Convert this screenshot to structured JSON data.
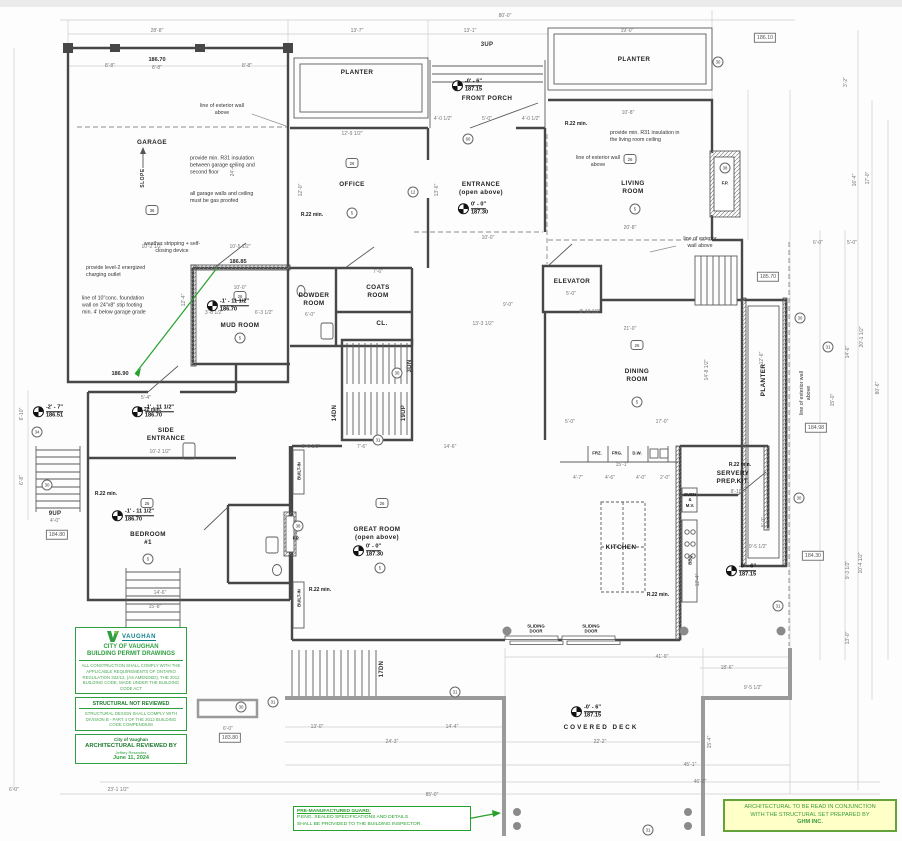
{
  "colors": {
    "wall": "#474747",
    "green": "#27a02c",
    "stamp_green": "#2f9e3f",
    "note_bg": "#ffffc8",
    "deck": "#9a9a9a"
  },
  "rooms": [
    {
      "name": "GARAGE",
      "x": 152,
      "y": 143
    },
    {
      "name": "PLANTER",
      "x": 357,
      "y": 73
    },
    {
      "name": "FRONT PORCH",
      "x": 487,
      "y": 99
    },
    {
      "name": "PLANTER",
      "x": 634,
      "y": 60
    },
    {
      "name": "OFFICE",
      "x": 352,
      "y": 185
    },
    {
      "name": "ENTRANCE\n(open above)",
      "x": 481,
      "y": 189
    },
    {
      "name": "LIVING\nROOM",
      "x": 633,
      "y": 188
    },
    {
      "name": "ELEVATOR",
      "x": 572,
      "y": 282
    },
    {
      "name": "POWDER\nROOM",
      "x": 314,
      "y": 300
    },
    {
      "name": "COATS\nROOM",
      "x": 378,
      "y": 292
    },
    {
      "name": "CL.",
      "x": 382,
      "y": 324
    },
    {
      "name": "MUD ROOM",
      "x": 240,
      "y": 326
    },
    {
      "name": "SIDE\nENTRANCE",
      "x": 166,
      "y": 435
    },
    {
      "name": "DINING\nROOM",
      "x": 637,
      "y": 376
    },
    {
      "name": "PLANTER",
      "x": 764,
      "y": 380,
      "r": -90
    },
    {
      "name": "BEDROOM\n#1",
      "x": 148,
      "y": 539
    },
    {
      "name": "GREAT ROOM\n(open above)",
      "x": 377,
      "y": 534
    },
    {
      "name": "KITCHEN",
      "x": 621,
      "y": 548
    },
    {
      "name": "SERVERY\nPREP.KIT.",
      "x": 733,
      "y": 478
    },
    {
      "name": "COVERED  DECK",
      "x": 601,
      "y": 728,
      "cls": "wide"
    }
  ],
  "elev_markers": [
    {
      "level": "-0' - 6\"",
      "elev": "187.15",
      "x": 467,
      "y": 86
    },
    {
      "level": "0' - 0\"",
      "elev": "187.30",
      "x": 473,
      "y": 209
    },
    {
      "level": "-1' - 11 1/2\"",
      "elev": "186.70",
      "x": 228,
      "y": 306
    },
    {
      "level": "-1' - 11 1/2\"",
      "elev": "186.70",
      "x": 153,
      "y": 412
    },
    {
      "level": "-2' - 7\"",
      "elev": "186.51",
      "x": 48,
      "y": 412
    },
    {
      "level": "-1' - 11 1/2\"",
      "elev": "186.70",
      "x": 133,
      "y": 516
    },
    {
      "level": "0' - 0\"",
      "elev": "187.30",
      "x": 368,
      "y": 551
    },
    {
      "level": "-0' - 6\"",
      "elev": "187.15",
      "x": 741,
      "y": 571
    },
    {
      "level": "-0' - 6\"",
      "elev": "187.15",
      "x": 586,
      "y": 712
    }
  ],
  "plain_elevs": [
    {
      "t": "186.70",
      "x": 157,
      "y": 60
    },
    {
      "t": "186.85",
      "x": 238,
      "y": 262
    },
    {
      "t": "186.90",
      "x": 120,
      "y": 374
    }
  ],
  "boxed_elevs": [
    {
      "t": "186.10",
      "x": 765,
      "y": 38
    },
    {
      "t": "185.70",
      "x": 768,
      "y": 277
    },
    {
      "t": "184.98",
      "x": 816,
      "y": 428
    },
    {
      "t": "184.30",
      "x": 813,
      "y": 556
    },
    {
      "t": "184.80",
      "x": 57,
      "y": 535
    },
    {
      "t": "183.80",
      "x": 230,
      "y": 738
    }
  ],
  "stair_labels": [
    {
      "t": "3UP",
      "x": 487,
      "y": 45
    },
    {
      "t": "9UP",
      "x": 55,
      "y": 514
    },
    {
      "t": "14DN",
      "x": 335,
      "y": 413,
      "r": -90
    },
    {
      "t": "19UP",
      "x": 404,
      "y": 413,
      "r": -90
    },
    {
      "t": "3DN",
      "x": 410,
      "y": 366,
      "r": -90
    },
    {
      "t": "17DN",
      "x": 382,
      "y": 669,
      "r": -90
    }
  ],
  "fixtures": [
    {
      "t": "F.P.",
      "x": 725,
      "y": 183
    },
    {
      "t": "F.P.",
      "x": 296,
      "y": 538
    },
    {
      "t": "BUILT-IN",
      "x": 299,
      "y": 471,
      "r": -90
    },
    {
      "t": "BUILT-IN",
      "x": 299,
      "y": 598,
      "r": -90
    },
    {
      "t": "FRZ.",
      "x": 597,
      "y": 453
    },
    {
      "t": "FRG.",
      "x": 617,
      "y": 453
    },
    {
      "t": "D.W.",
      "x": 637,
      "y": 453
    },
    {
      "t": "OVEN\n&\nM.V.",
      "x": 690,
      "y": 500
    },
    {
      "t": "BBQ",
      "x": 690,
      "y": 560,
      "r": -90
    },
    {
      "t": "SLIDING\nDOOR",
      "x": 536,
      "y": 629
    },
    {
      "t": "SLIDING\nDOOR",
      "x": 591,
      "y": 629
    }
  ],
  "r22_notes": [
    {
      "t": "R.22 min.",
      "x": 312,
      "y": 215
    },
    {
      "t": "R.22 min.",
      "x": 576,
      "y": 124
    },
    {
      "t": "R.22 min.",
      "x": 150,
      "y": 410
    },
    {
      "t": "R.22 min.",
      "x": 106,
      "y": 494
    },
    {
      "t": "R.22 min.",
      "x": 320,
      "y": 590
    },
    {
      "t": "R.22 min.",
      "x": 658,
      "y": 595
    },
    {
      "t": "R.22 min.",
      "x": 740,
      "y": 465
    }
  ],
  "notes": [
    {
      "t": "line of exterior wall\nabove",
      "x": 222,
      "y": 110,
      "cls": "c"
    },
    {
      "t": "provide min. R31 insulation\nbetween garage ceiling and\nsecond floor",
      "x": 190,
      "y": 166,
      "al": "l"
    },
    {
      "t": "all garage walls and ceiling\nmust be gas proofed",
      "x": 190,
      "y": 198,
      "al": "l"
    },
    {
      "t": "weather stripping + self-\nclosing device",
      "x": 172,
      "y": 248,
      "cls": "c"
    },
    {
      "t": "provide level-2 energized\ncharging outlet",
      "x": 86,
      "y": 272,
      "al": "l"
    },
    {
      "t": "line of 10\"conc. foundation\nwall on 24\"x8\" stip footing\nmin. 4' below garage grade",
      "x": 82,
      "y": 306,
      "al": "l"
    },
    {
      "t": "provide min. R31 insulation in\nthe living room ceiling",
      "x": 610,
      "y": 137,
      "al": "l"
    },
    {
      "t": "line of exterior wall\nabove",
      "x": 598,
      "y": 162,
      "cls": "c"
    },
    {
      "t": "line of exterior\nwall above",
      "x": 700,
      "y": 243,
      "cls": "c"
    },
    {
      "t": "line of exterior wall\nabove",
      "x": 806,
      "y": 393,
      "cls": "c",
      "r": -90
    },
    {
      "t": "SLOPE",
      "x": 143,
      "y": 178,
      "cls": "slope",
      "r": -90
    }
  ],
  "tags": [
    {
      "n": "36",
      "x": 152,
      "y": 210,
      "shape": "hex"
    },
    {
      "n": "26",
      "x": 352,
      "y": 163,
      "shape": "hex"
    },
    {
      "n": "26",
      "x": 630,
      "y": 159,
      "shape": "hex"
    },
    {
      "n": "26",
      "x": 240,
      "y": 296,
      "shape": "hex"
    },
    {
      "n": "26",
      "x": 637,
      "y": 345,
      "shape": "hex"
    },
    {
      "n": "26",
      "x": 382,
      "y": 503,
      "shape": "hex"
    },
    {
      "n": "26",
      "x": 147,
      "y": 503,
      "shape": "hex"
    },
    {
      "n": "5",
      "x": 352,
      "y": 213,
      "shape": "circ"
    },
    {
      "n": "5",
      "x": 635,
      "y": 209,
      "shape": "circ"
    },
    {
      "n": "5",
      "x": 240,
      "y": 338,
      "shape": "circ"
    },
    {
      "n": "5",
      "x": 637,
      "y": 402,
      "shape": "circ"
    },
    {
      "n": "5",
      "x": 380,
      "y": 568,
      "shape": "circ"
    },
    {
      "n": "5",
      "x": 148,
      "y": 559,
      "shape": "circ"
    },
    {
      "n": "12",
      "x": 413,
      "y": 192,
      "shape": "circ"
    },
    {
      "n": "60",
      "x": 468,
      "y": 139,
      "shape": "circ"
    },
    {
      "n": "30",
      "x": 718,
      "y": 62,
      "shape": "circ"
    },
    {
      "n": "30",
      "x": 397,
      "y": 373,
      "shape": "circ"
    },
    {
      "n": "31",
      "x": 378,
      "y": 440,
      "shape": "circ"
    },
    {
      "n": "34",
      "x": 37,
      "y": 432,
      "shape": "circ"
    },
    {
      "n": "30",
      "x": 47,
      "y": 485,
      "shape": "circ"
    },
    {
      "n": "30",
      "x": 241,
      "y": 707,
      "shape": "circ"
    },
    {
      "n": "31",
      "x": 273,
      "y": 702,
      "shape": "circ"
    },
    {
      "n": "31",
      "x": 455,
      "y": 692,
      "shape": "circ"
    },
    {
      "n": "30",
      "x": 800,
      "y": 318,
      "shape": "circ"
    },
    {
      "n": "31",
      "x": 828,
      "y": 347,
      "shape": "circ"
    },
    {
      "n": "30",
      "x": 799,
      "y": 498,
      "shape": "circ"
    },
    {
      "n": "31",
      "x": 778,
      "y": 606,
      "shape": "circ"
    },
    {
      "n": "38",
      "x": 725,
      "y": 168,
      "shape": "circ"
    },
    {
      "n": "38",
      "x": 298,
      "y": 526,
      "shape": "circ"
    },
    {
      "n": "31",
      "x": 648,
      "y": 830,
      "shape": "circ"
    }
  ],
  "dims": [
    {
      "t": "80'-0\"",
      "x": 505,
      "y": 16
    },
    {
      "t": "28'-8\"",
      "x": 157,
      "y": 31
    },
    {
      "t": "13'-7\"",
      "x": 357,
      "y": 31
    },
    {
      "t": "13'-1\"",
      "x": 470,
      "y": 31
    },
    {
      "t": "19'-0\"",
      "x": 627,
      "y": 31
    },
    {
      "t": "8'-8\"",
      "x": 110,
      "y": 66
    },
    {
      "t": "8'-8\"",
      "x": 157,
      "y": 68
    },
    {
      "t": "8'-8\"",
      "x": 247,
      "y": 66
    },
    {
      "t": "4'-0 1/2\"",
      "x": 443,
      "y": 119
    },
    {
      "t": "5'-0\"",
      "x": 487,
      "y": 119
    },
    {
      "t": "4'-0 1/2\"",
      "x": 531,
      "y": 119
    },
    {
      "t": "10'-8\"",
      "x": 628,
      "y": 113
    },
    {
      "t": "12'-9 1/2\"",
      "x": 352,
      "y": 134
    },
    {
      "t": "20'-8\"",
      "x": 630,
      "y": 228
    },
    {
      "t": "12'-0\"",
      "x": 301,
      "y": 190,
      "r": -90
    },
    {
      "t": "13'-6\"",
      "x": 437,
      "y": 190,
      "r": -90
    },
    {
      "t": "24'-4\"",
      "x": 233,
      "y": 170,
      "r": -90
    },
    {
      "t": "10'-2 1/2\"",
      "x": 152,
      "y": 247
    },
    {
      "t": "10'-5 1/2\"",
      "x": 240,
      "y": 247
    },
    {
      "t": "12'-4\"",
      "x": 184,
      "y": 300,
      "r": -90
    },
    {
      "t": "10'-0\"",
      "x": 240,
      "y": 288
    },
    {
      "t": "3'-8 1/2\"",
      "x": 214,
      "y": 313
    },
    {
      "t": "6'-3 1/2\"",
      "x": 264,
      "y": 313
    },
    {
      "t": "7'-6\"",
      "x": 378,
      "y": 272
    },
    {
      "t": "6'-0\"",
      "x": 310,
      "y": 315
    },
    {
      "t": "9'-0\"",
      "x": 508,
      "y": 305
    },
    {
      "t": "13'-3 1/2\"",
      "x": 483,
      "y": 324
    },
    {
      "t": "8'-10 1/2\"",
      "x": 590,
      "y": 312
    },
    {
      "t": "5'-0\"",
      "x": 571,
      "y": 294
    },
    {
      "t": "21'-0\"",
      "x": 630,
      "y": 329
    },
    {
      "t": "17'-0\"",
      "x": 662,
      "y": 422
    },
    {
      "t": "5'-0\"",
      "x": 570,
      "y": 422
    },
    {
      "t": "14'-8 1/2\"",
      "x": 707,
      "y": 370,
      "r": -90
    },
    {
      "t": "5'-4\"",
      "x": 146,
      "y": 398
    },
    {
      "t": "10'-2 1/2\"",
      "x": 160,
      "y": 452
    },
    {
      "t": "15'-8\"",
      "x": 155,
      "y": 607
    },
    {
      "t": "14'-6\"",
      "x": 160,
      "y": 593
    },
    {
      "t": "6'-10\"",
      "x": 22,
      "y": 414,
      "r": -90
    },
    {
      "t": "6'-8\"",
      "x": 22,
      "y": 480,
      "r": -90
    },
    {
      "t": "4'-0\"",
      "x": 55,
      "y": 521
    },
    {
      "t": "5'-6 1/2\"",
      "x": 311,
      "y": 447
    },
    {
      "t": "7'-6\"",
      "x": 362,
      "y": 447
    },
    {
      "t": "14'-6\"",
      "x": 450,
      "y": 447
    },
    {
      "t": "22'-3 1/2\"",
      "x": 297,
      "y": 530,
      "r": -90
    },
    {
      "t": "15'-1\"",
      "x": 622,
      "y": 465
    },
    {
      "t": "4'-7\"",
      "x": 578,
      "y": 478
    },
    {
      "t": "4'-6\"",
      "x": 610,
      "y": 478
    },
    {
      "t": "4'-0\"",
      "x": 641,
      "y": 478
    },
    {
      "t": "2'-0\"",
      "x": 665,
      "y": 478
    },
    {
      "t": "8'-10\"",
      "x": 737,
      "y": 492
    },
    {
      "t": "9'-5 1/2\"",
      "x": 758,
      "y": 547
    },
    {
      "t": "12'-4\"",
      "x": 698,
      "y": 580,
      "r": -90
    },
    {
      "t": "12'-6\"",
      "x": 762,
      "y": 358,
      "r": -90
    },
    {
      "t": "5'-0\"",
      "x": 764,
      "y": 522,
      "r": -90
    },
    {
      "t": "6'-0\"",
      "x": 818,
      "y": 243
    },
    {
      "t": "5'-0\"",
      "x": 852,
      "y": 243
    },
    {
      "t": "3'-2\"",
      "x": 846,
      "y": 82,
      "r": -90
    },
    {
      "t": "16'-4\"",
      "x": 855,
      "y": 180,
      "r": -90
    },
    {
      "t": "17'-0\"",
      "x": 868,
      "y": 178,
      "r": -90
    },
    {
      "t": "20'-1 1/2\"",
      "x": 862,
      "y": 337,
      "r": -90
    },
    {
      "t": "14'-6\"",
      "x": 848,
      "y": 352,
      "r": -90
    },
    {
      "t": "80'-6\"",
      "x": 878,
      "y": 388,
      "r": -90
    },
    {
      "t": "15'-0\"",
      "x": 833,
      "y": 400,
      "r": -90
    },
    {
      "t": "9'-3 1/2\"",
      "x": 848,
      "y": 570,
      "r": -90
    },
    {
      "t": "10'-4 1/2\"",
      "x": 861,
      "y": 563,
      "r": -90
    },
    {
      "t": "13'-0\"",
      "x": 848,
      "y": 638,
      "r": -90
    },
    {
      "t": "9'-5 1/2\"",
      "x": 753,
      "y": 688
    },
    {
      "t": "15'-4\"",
      "x": 710,
      "y": 742,
      "r": -90
    },
    {
      "t": "41'-9\"",
      "x": 662,
      "y": 657
    },
    {
      "t": "18'-6\"",
      "x": 727,
      "y": 668
    },
    {
      "t": "13'-0\"",
      "x": 317,
      "y": 727
    },
    {
      "t": "14'-4\"",
      "x": 452,
      "y": 727
    },
    {
      "t": "24'-3\"",
      "x": 392,
      "y": 742
    },
    {
      "t": "22'-2\"",
      "x": 600,
      "y": 742
    },
    {
      "t": "45'-1\"",
      "x": 690,
      "y": 765
    },
    {
      "t": "46'-5\"",
      "x": 700,
      "y": 782
    },
    {
      "t": "85'-0\"",
      "x": 432,
      "y": 795
    },
    {
      "t": "23'-1 1/2\"",
      "x": 118,
      "y": 790
    },
    {
      "t": "6'-0\"",
      "x": 228,
      "y": 729
    },
    {
      "t": "6'-0\"",
      "x": 14,
      "y": 790
    },
    {
      "t": "10'-0\"",
      "x": 488,
      "y": 238
    }
  ],
  "stamp": {
    "logo_text": "VAUGHAN",
    "title": "CITY OF VAUGHAN\nBUILDING PERMIT DRAWINGS",
    "body": "ALL CONSTRUCTION SHALL COMPLY WITH THE APPLICABLE REQUIREMENTS OF ONTARIO REGULATION 332/12, (AS AMENDED), THE 2012 BUILDING CODE, MADE UNDER THE BUILDING CODE ACT",
    "structural_title": "STRUCTURAL NOT REVIEWED",
    "structural_body": "STRUCTURAL DESIGN SHALL COMPLY WITH DIVISION B - PART 4 OF THE 2012 BUILDING CODE COMPENDIUM",
    "reviewed_org": "City of Vaughan",
    "reviewed_title": "ARCHITECTURAL REVIEWED BY",
    "reviewer": "Jeffrey Resendes",
    "date": "June 11, 2024"
  },
  "guard_note": {
    "title": "PRE-MANUFACTURED GUARD:",
    "body": "P.ENG. SEALED SPECIFICATIONS AND DETAILS\nSHALL BE PROVIDED TO THE BUILDING INSPECTOR."
  },
  "ghm_note": {
    "line1": "ARCHITECTURAL TO BE READ IN CONJUNCTION\nWITH THE STRUCTURAL SET PREPARED BY",
    "line2": "GHM INC."
  }
}
